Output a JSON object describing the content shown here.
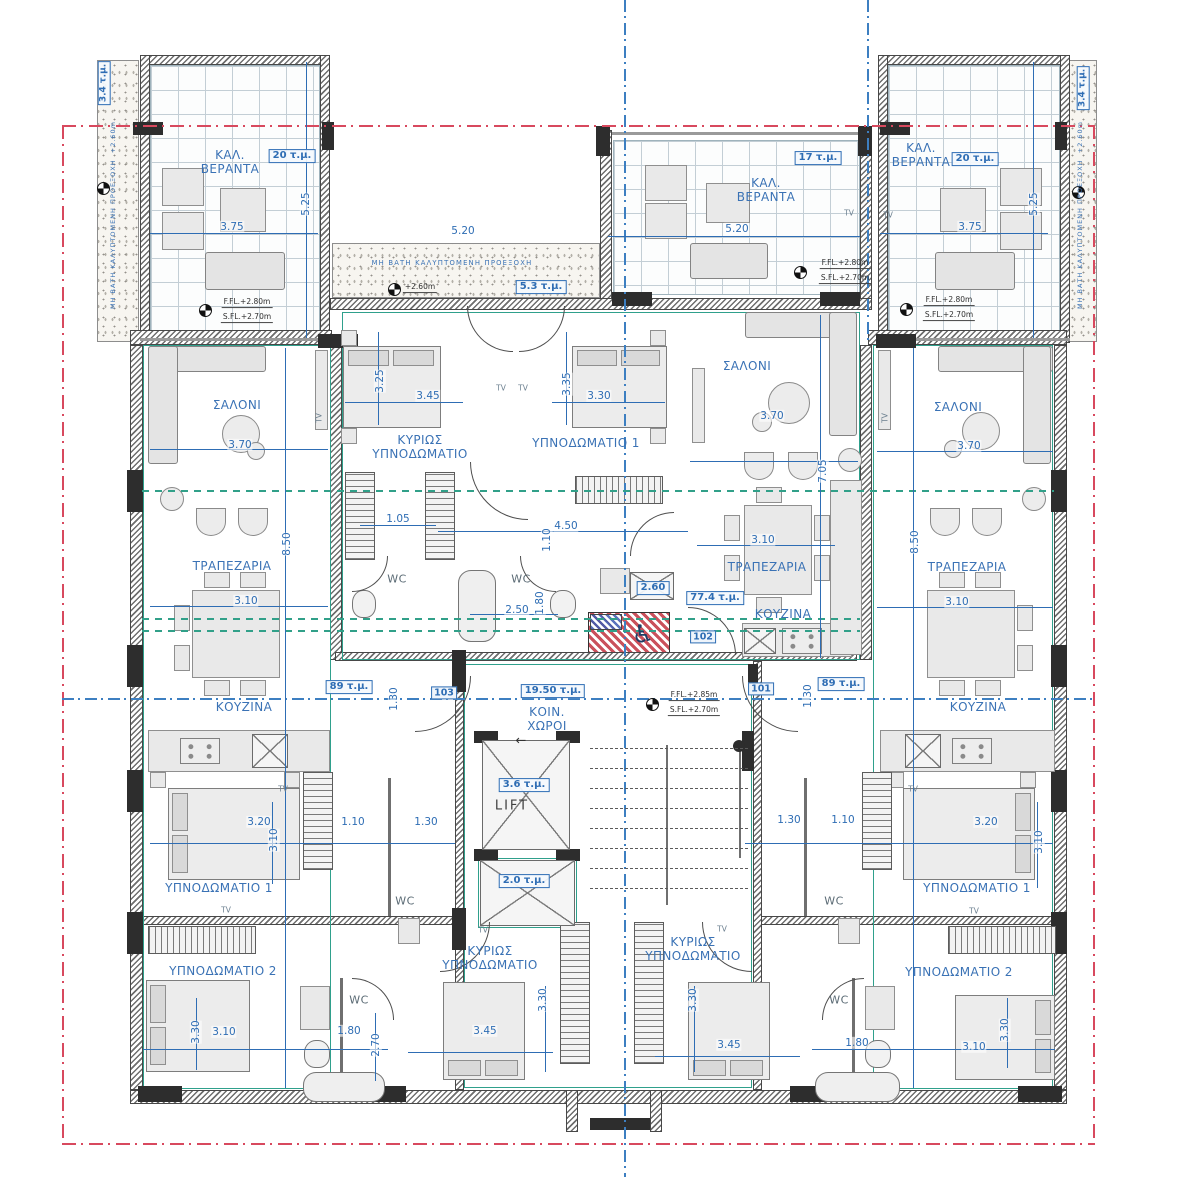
{
  "drawing": {
    "kind": "apartment-floor-plan"
  },
  "summary": {
    "units": [
      {
        "number": "101",
        "area": "89 τ.μ."
      },
      {
        "number": "102",
        "area": "77.4 τ.μ."
      },
      {
        "number": "103",
        "area": "89 τ.μ."
      }
    ],
    "common_area_label": "ΚΟΙΝ. ΧΩΡΟΙ",
    "common_area": "19.50 τ.μ.",
    "lift_label": "LIFT",
    "lift_area": "3.6 τ.μ.",
    "shaft_area": "2.0 τ.μ.",
    "veranda_areas": [
      "20 τ.μ.",
      "17 τ.μ.",
      "20 τ.μ.",
      "3.4 τ.μ.",
      "3.4 τ.μ.",
      "5.3 τ.μ."
    ]
  },
  "colors": {
    "dimension_blue": "#2e6db4",
    "boundary_red": "#d8495e",
    "partition_teal": "#2fa08c",
    "wall_gray": "#6e6e6e"
  },
  "labels": [
    {
      "name": "veranda-left-title",
      "kind": "room",
      "text": "ΚΑΛ.\nΒΕΡΑΝΤΑ",
      "x": 230,
      "y": 162
    },
    {
      "name": "veranda-left-area",
      "kind": "area",
      "text": "20 τ.μ.",
      "x": 292,
      "y": 156
    },
    {
      "name": "dim-veranda-left-w",
      "kind": "dim",
      "text": "3.75",
      "x": 232,
      "y": 227
    },
    {
      "name": "dim-veranda-left-h",
      "kind": "dimr",
      "text": "5.25",
      "x": 306,
      "y": 204
    },
    {
      "name": "level-veranda-left-ffl",
      "kind": "lvl",
      "text": "F.FL.+2.80m",
      "x": 247,
      "y": 303
    },
    {
      "name": "level-veranda-left-sfl",
      "kind": "lvl",
      "text": "S.FL.+2.70m",
      "x": 247,
      "y": 318
    },
    {
      "name": "veranda-mid-title",
      "kind": "room",
      "text": "ΚΑΛ.\nΒΕΡΑΝΤΑ",
      "x": 766,
      "y": 190
    },
    {
      "name": "veranda-mid-area",
      "kind": "area",
      "text": "17 τ.μ.",
      "x": 818,
      "y": 158
    },
    {
      "name": "dim-veranda-mid-w",
      "kind": "dim",
      "text": "5.20",
      "x": 737,
      "y": 229
    },
    {
      "name": "tv-veranda-mid-1",
      "kind": "tv",
      "text": "TV",
      "x": 849,
      "y": 214
    },
    {
      "name": "tv-veranda-mid-2",
      "kind": "tv",
      "text": "TV",
      "x": 888,
      "y": 216
    },
    {
      "name": "level-veranda-mid-ffl",
      "kind": "lvl",
      "text": "F.FL.+2.80m",
      "x": 845,
      "y": 264
    },
    {
      "name": "level-veranda-mid-sfl",
      "kind": "lvl",
      "text": "S.FL.+2.70m",
      "x": 845,
      "y": 279
    },
    {
      "name": "veranda-right-title",
      "kind": "room",
      "text": "ΚΑΛ.\nΒΕΡΑΝΤΑ",
      "x": 921,
      "y": 155
    },
    {
      "name": "veranda-right-area",
      "kind": "area",
      "text": "20 τ.μ.",
      "x": 975,
      "y": 159
    },
    {
      "name": "dim-veranda-right-w",
      "kind": "dim",
      "text": "3.75",
      "x": 970,
      "y": 227
    },
    {
      "name": "dim-veranda-right-h",
      "kind": "dimr",
      "text": "5.25",
      "x": 1034,
      "y": 204
    },
    {
      "name": "level-veranda-right-ffl",
      "kind": "lvl",
      "text": "F.FL.+2.80m",
      "x": 949,
      "y": 301
    },
    {
      "name": "level-veranda-right-sfl",
      "kind": "lvl",
      "text": "S.FL.+2.70m",
      "x": 949,
      "y": 316
    },
    {
      "name": "strip-left-area",
      "kind": "arear",
      "text": "3.4 τ.μ.",
      "x": 104,
      "y": 83
    },
    {
      "name": "strip-right-area",
      "kind": "arear",
      "text": "3.4 τ.μ.",
      "x": 1083,
      "y": 88
    },
    {
      "name": "strip-left-note",
      "kind": "tinyr",
      "text": "ΜΗ ΒΑΤΗ ΚΑΛΥΠΤΟΜΕΝΗ ΠΡΟΕΞΟΧΗ  +2.60m",
      "x": 114,
      "y": 215
    },
    {
      "name": "strip-right-note",
      "kind": "tinyr",
      "text": "ΜΗ ΒΑΤΗ ΚΑΛΥΠΤΟΜΕΝΗ ΠΡΟΕΞΟΧΗ  +2.60m",
      "x": 1081,
      "y": 215
    },
    {
      "name": "strip-top-note",
      "kind": "tiny",
      "text": "ΜΗ ΒΑΤΗ ΚΑΛΥΠΤΟΜΕΝΗ ΠΡΟΕΞΟΧΗ",
      "x": 452,
      "y": 263
    },
    {
      "name": "strip-top-level",
      "kind": "lvl",
      "text": "+2.60m",
      "x": 420,
      "y": 288
    },
    {
      "name": "strip-top-area",
      "kind": "area",
      "text": "5.3 τ.μ.",
      "x": 541,
      "y": 287
    },
    {
      "name": "dim-strip-top",
      "kind": "dim",
      "text": "5.20",
      "x": 463,
      "y": 231
    },
    {
      "name": "apt103-salon",
      "kind": "room",
      "text": "ΣΑΛΟΝΙ",
      "x": 237,
      "y": 405
    },
    {
      "name": "dim-apt103-salon",
      "kind": "dim",
      "text": "3.70",
      "x": 240,
      "y": 445
    },
    {
      "name": "tv-apt103-salon",
      "kind": "tvr",
      "text": "TV",
      "x": 320,
      "y": 418
    },
    {
      "name": "apt103-dining",
      "kind": "room",
      "text": "ΤΡΑΠΕΖΑΡΙΑ",
      "x": 232,
      "y": 566
    },
    {
      "name": "dim-apt103-dining",
      "kind": "dim",
      "text": "3.10",
      "x": 246,
      "y": 601
    },
    {
      "name": "dim-apt103-height",
      "kind": "dimr",
      "text": "8.50",
      "x": 287,
      "y": 544
    },
    {
      "name": "apt103-kitchen",
      "kind": "room",
      "text": "ΚΟΥΖΙΝΑ",
      "x": 244,
      "y": 707
    },
    {
      "name": "apt103-area",
      "kind": "area",
      "text": "89 τ.μ.",
      "x": 349,
      "y": 687
    },
    {
      "name": "dim-apt103-130v",
      "kind": "dimr",
      "text": "1.30",
      "x": 394,
      "y": 699
    },
    {
      "name": "apt103-bedroom1",
      "kind": "room",
      "text": "ΥΠΝΟΔΩΜΑΤΙΟ 1",
      "x": 219,
      "y": 888
    },
    {
      "name": "dim-apt103-bed1-w",
      "kind": "dim",
      "text": "3.20",
      "x": 259,
      "y": 822
    },
    {
      "name": "dim-apt103-110",
      "kind": "dim",
      "text": "1.10",
      "x": 353,
      "y": 822
    },
    {
      "name": "dim-apt103-130",
      "kind": "dim",
      "text": "1.30",
      "x": 426,
      "y": 822
    },
    {
      "name": "dim-apt103-bed1-h",
      "kind": "dimr",
      "text": "3.10",
      "x": 274,
      "y": 840
    },
    {
      "name": "tv-apt103-bed1",
      "kind": "tv",
      "text": "TV",
      "x": 283,
      "y": 790
    },
    {
      "name": "apt103-wc1",
      "kind": "wc",
      "text": "WC",
      "x": 405,
      "y": 902
    },
    {
      "name": "apt103-bedroom2",
      "kind": "room",
      "text": "ΥΠΝΟΔΩΜΑΤΙΟ 2",
      "x": 223,
      "y": 971
    },
    {
      "name": "tv-apt103-bed2",
      "kind": "tv",
      "text": "TV",
      "x": 226,
      "y": 911
    },
    {
      "name": "dim-apt103-bed2-w",
      "kind": "dim",
      "text": "3.10",
      "x": 224,
      "y": 1032
    },
    {
      "name": "dim-apt103-bed2-h",
      "kind": "dimr",
      "text": "3.30",
      "x": 196,
      "y": 1032
    },
    {
      "name": "dim-apt103-180",
      "kind": "dim",
      "text": "1.80",
      "x": 349,
      "y": 1031
    },
    {
      "name": "dim-apt103-270",
      "kind": "dimr",
      "text": "2.70",
      "x": 376,
      "y": 1045
    },
    {
      "name": "apt103-wc2",
      "kind": "wc",
      "text": "WC",
      "x": 359,
      "y": 1001
    },
    {
      "name": "apt102-master",
      "kind": "room",
      "text": "ΚΥΡΙΩΣ\nΥΠΝΟΔΩΜΑΤΙΟ",
      "x": 420,
      "y": 447
    },
    {
      "name": "dim-apt102-master-w",
      "kind": "dim",
      "text": "3.45",
      "x": 428,
      "y": 396
    },
    {
      "name": "dim-apt102-master-h",
      "kind": "dimr",
      "text": "3.25",
      "x": 380,
      "y": 381
    },
    {
      "name": "apt102-bedroom1",
      "kind": "room",
      "text": "ΥΠΝΟΔΩΜΑΤΙΟ 1",
      "x": 586,
      "y": 443
    },
    {
      "name": "dim-apt102-bed1-w",
      "kind": "dim",
      "text": "3.30",
      "x": 599,
      "y": 396
    },
    {
      "name": "dim-apt102-bed1-h",
      "kind": "dimr",
      "text": "3.35",
      "x": 567,
      "y": 384
    },
    {
      "name": "tv-apt102-1",
      "kind": "tv",
      "text": "TV",
      "x": 501,
      "y": 389
    },
    {
      "name": "tv-apt102-2",
      "kind": "tv",
      "text": "TV",
      "x": 523,
      "y": 389
    },
    {
      "name": "dim-apt102-105",
      "kind": "dim",
      "text": "1.05",
      "x": 398,
      "y": 519
    },
    {
      "name": "dim-apt102-450",
      "kind": "dim",
      "text": "4.50",
      "x": 566,
      "y": 526
    },
    {
      "name": "dim-apt102-110",
      "kind": "dimr",
      "text": "1.10",
      "x": 547,
      "y": 540
    },
    {
      "name": "apt102-wc1",
      "kind": "wc",
      "text": "WC",
      "x": 397,
      "y": 580
    },
    {
      "name": "apt102-wc2",
      "kind": "wc",
      "text": "WC",
      "x": 521,
      "y": 580
    },
    {
      "name": "dim-apt102-250",
      "kind": "dim",
      "text": "2.50",
      "x": 517,
      "y": 610
    },
    {
      "name": "dim-apt102-180",
      "kind": "dimr",
      "text": "1.80",
      "x": 540,
      "y": 603
    },
    {
      "name": "apt102-260",
      "kind": "area",
      "text": "2.60",
      "x": 653,
      "y": 588
    },
    {
      "name": "apt102-salon",
      "kind": "room",
      "text": "ΣΑΛΟΝΙ",
      "x": 747,
      "y": 366
    },
    {
      "name": "dim-apt102-salon",
      "kind": "dim",
      "text": "3.70",
      "x": 772,
      "y": 416
    },
    {
      "name": "apt102-dining",
      "kind": "room",
      "text": "ΤΡΑΠΕΖΑΡΙΑ",
      "x": 767,
      "y": 567
    },
    {
      "name": "dim-apt102-dining",
      "kind": "dim",
      "text": "3.10",
      "x": 763,
      "y": 540
    },
    {
      "name": "apt102-kitchen",
      "kind": "room",
      "text": "ΚΟΥΖΙΝΑ",
      "x": 783,
      "y": 614
    },
    {
      "name": "dim-apt102-705",
      "kind": "dimr",
      "text": "7.05",
      "x": 823,
      "y": 471
    },
    {
      "name": "apt102-area",
      "kind": "area",
      "text": "77.4 τ.μ.",
      "x": 715,
      "y": 598
    },
    {
      "name": "apt102-number",
      "kind": "doornum",
      "text": "102",
      "x": 703,
      "y": 637
    },
    {
      "name": "core-area",
      "kind": "area",
      "text": "19.50 τ.μ.",
      "x": 553,
      "y": 691
    },
    {
      "name": "core-title",
      "kind": "room",
      "text": "ΚΟΙΝ.\nΧΩΡΟΙ",
      "x": 547,
      "y": 719
    },
    {
      "name": "core-arrow",
      "kind": "arrow",
      "text": "←",
      "x": 521,
      "y": 741
    },
    {
      "name": "core-ffl",
      "kind": "lvl",
      "text": "F.FL.+2.85m",
      "x": 694,
      "y": 696
    },
    {
      "name": "core-sfl",
      "kind": "lvl",
      "text": "S.FL.+2.70m",
      "x": 694,
      "y": 711
    },
    {
      "name": "apt103-number",
      "kind": "doornum",
      "text": "103",
      "x": 444,
      "y": 693
    },
    {
      "name": "apt101-number",
      "kind": "doornum",
      "text": "101",
      "x": 761,
      "y": 689
    },
    {
      "name": "lift-area",
      "kind": "area",
      "text": "3.6 τ.μ.",
      "x": 524,
      "y": 785
    },
    {
      "name": "lift-title",
      "kind": "lift",
      "text": "LIFT",
      "x": 512,
      "y": 806
    },
    {
      "name": "shaft-area",
      "kind": "area",
      "text": "2.0 τ.μ.",
      "x": 524,
      "y": 881
    },
    {
      "name": "accessible-icon",
      "kind": "wheel",
      "text": "♿",
      "x": 643,
      "y": 634
    },
    {
      "name": "apt101-salon",
      "kind": "room",
      "text": "ΣΑΛΟΝΙ",
      "x": 958,
      "y": 407
    },
    {
      "name": "dim-apt101-salon",
      "kind": "dim",
      "text": "3.70",
      "x": 969,
      "y": 446
    },
    {
      "name": "tv-apt101-salon",
      "kind": "tvr",
      "text": "TV",
      "x": 886,
      "y": 418
    },
    {
      "name": "apt101-dining",
      "kind": "room",
      "text": "ΤΡΑΠΕΖΑΡΙΑ",
      "x": 967,
      "y": 567
    },
    {
      "name": "dim-apt101-dining",
      "kind": "dim",
      "text": "3.10",
      "x": 957,
      "y": 602
    },
    {
      "name": "dim-apt101-height",
      "kind": "dimr",
      "text": "8.50",
      "x": 915,
      "y": 542
    },
    {
      "name": "apt101-kitchen",
      "kind": "room",
      "text": "ΚΟΥΖΙΝΑ",
      "x": 978,
      "y": 707
    },
    {
      "name": "apt101-area",
      "kind": "area",
      "text": "89 τ.μ.",
      "x": 841,
      "y": 684
    },
    {
      "name": "dim-apt101-130v",
      "kind": "dimr",
      "text": "1.30",
      "x": 808,
      "y": 696
    },
    {
      "name": "apt101-bedroom1",
      "kind": "room",
      "text": "ΥΠΝΟΔΩΜΑΤΙΟ 1",
      "x": 977,
      "y": 888
    },
    {
      "name": "dim-apt101-130",
      "kind": "dim",
      "text": "1.30",
      "x": 789,
      "y": 820
    },
    {
      "name": "dim-apt101-110",
      "kind": "dim",
      "text": "1.10",
      "x": 843,
      "y": 820
    },
    {
      "name": "dim-apt101-bed1-w",
      "kind": "dim",
      "text": "3.20",
      "x": 986,
      "y": 822
    },
    {
      "name": "dim-apt101-bed1-h",
      "kind": "dimr",
      "text": "3.10",
      "x": 1039,
      "y": 842
    },
    {
      "name": "tv-apt101-bed1",
      "kind": "tv",
      "text": "TV",
      "x": 913,
      "y": 790
    },
    {
      "name": "apt101-wc1",
      "kind": "wc",
      "text": "WC",
      "x": 834,
      "y": 902
    },
    {
      "name": "apt101-bedroom2",
      "kind": "room",
      "text": "ΥΠΝΟΔΩΜΑΤΙΟ 2",
      "x": 959,
      "y": 972
    },
    {
      "name": "tv-apt101-bed2",
      "kind": "tv",
      "text": "TV",
      "x": 974,
      "y": 912
    },
    {
      "name": "dim-apt101-bed2-w",
      "kind": "dim",
      "text": "3.10",
      "x": 974,
      "y": 1047
    },
    {
      "name": "dim-apt101-bed2-h",
      "kind": "dimr",
      "text": "3.30",
      "x": 1005,
      "y": 1030
    },
    {
      "name": "dim-apt101-180",
      "kind": "dim",
      "text": "1.80",
      "x": 857,
      "y": 1043
    },
    {
      "name": "apt101-wc2",
      "kind": "wc",
      "text": "WC",
      "x": 839,
      "y": 1001
    },
    {
      "name": "apt102-masterB-left",
      "kind": "room",
      "text": "ΚΥΡΙΩΣ\nΥΠΝΟΔΩΜΑΤΙΟ",
      "x": 490,
      "y": 958
    },
    {
      "name": "dim-masterB-left-w",
      "kind": "dim",
      "text": "3.45",
      "x": 485,
      "y": 1031
    },
    {
      "name": "dim-masterB-left-h",
      "kind": "dimr",
      "text": "3.30",
      "x": 543,
      "y": 1000
    },
    {
      "name": "tv-masterB-left",
      "kind": "tv",
      "text": "TV",
      "x": 483,
      "y": 931
    },
    {
      "name": "apt101-masterB-right",
      "kind": "room",
      "text": "ΚΥΡΙΩΣ\nΥΠΝΟΔΩΜΑΤΙΟ",
      "x": 693,
      "y": 949
    },
    {
      "name": "dim-masterB-right-w",
      "kind": "dim",
      "text": "3.45",
      "x": 729,
      "y": 1045
    },
    {
      "name": "dim-masterB-right-h",
      "kind": "dimr",
      "text": "3.30",
      "x": 693,
      "y": 1000
    },
    {
      "name": "tv-masterB-right",
      "kind": "tv",
      "text": "TV",
      "x": 722,
      "y": 930
    }
  ]
}
